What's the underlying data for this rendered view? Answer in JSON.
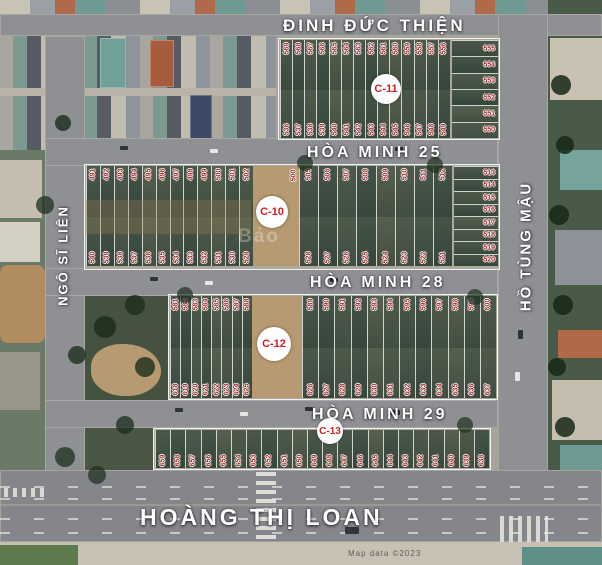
{
  "map": {
    "streets": {
      "dinh_duc_thien": "ĐINH ĐỨC THIỆN",
      "hoa_minh_25": "HÒA MINH 25",
      "hoa_minh_28": "HÒA MINH 28",
      "hoa_minh_29": "HÒA MINH 29",
      "hoang_thi_loan": "HOÀNG THỊ LOAN",
      "ngo_si_lien": "NGÔ SĨ LIÊN",
      "ho_tung_mau": "HỒ TÙNG MẬU"
    },
    "blocks": {
      "c11": {
        "label": "C-11",
        "top_row": [
          "569",
          "568",
          "567",
          "566",
          "565",
          "564",
          "563",
          "562",
          "561",
          "560",
          "559",
          "558",
          "557",
          "556"
        ],
        "bottom_row": [
          "536",
          "537",
          "538",
          "539",
          "540",
          "541",
          "542",
          "543",
          "544",
          "545",
          "546",
          "547",
          "548",
          "549"
        ],
        "stack": [
          "555",
          "554",
          "553",
          "552",
          "551",
          "550"
        ]
      },
      "c10": {
        "label": "C-10",
        "top_left": [
          "491",
          "492",
          "493",
          "494",
          "495",
          "496",
          "497",
          "498",
          "499",
          "500",
          "501",
          "502"
        ],
        "top_right": [
          "505",
          "506",
          "507",
          "508",
          "509",
          "510",
          "511",
          "512"
        ],
        "bottom_left": [
          "540",
          "539",
          "538",
          "537",
          "536",
          "535",
          "534",
          "533",
          "532",
          "531",
          "530",
          "529"
        ],
        "bottom_right": [
          "528",
          "527",
          "526",
          "525",
          "524",
          "523",
          "522",
          "521"
        ],
        "stack": [
          "513",
          "514",
          "515",
          "516",
          "517",
          "518",
          "519",
          "520"
        ],
        "gap_number": "500"
      },
      "c12": {
        "label": "C-12",
        "top_left": [
          "581",
          "582",
          "583",
          "584",
          "585",
          "586",
          "587",
          "588"
        ],
        "top_right": [
          "589",
          "590",
          "591",
          "592",
          "593",
          "594",
          "595",
          "596",
          "597",
          "598",
          "599",
          "600"
        ],
        "bottom_left": [
          "618",
          "619",
          "620",
          "621",
          "622",
          "623",
          "624",
          "625"
        ],
        "bottom_right": [
          "626",
          "627",
          "628",
          "629",
          "630",
          "631",
          "632",
          "633",
          "634",
          "635",
          "636",
          "637"
        ]
      },
      "c13": {
        "label": "C-13",
        "row": [
          "659",
          "658",
          "657",
          "656",
          "655",
          "654",
          "653",
          "652",
          "651",
          "650",
          "649",
          "648",
          "647",
          "646",
          "645",
          "644",
          "643",
          "642",
          "641",
          "640",
          "639",
          "638"
        ]
      }
    },
    "watermark": "Bảo",
    "attribution": "Map data ©2023",
    "colors": {
      "plot_number": "#a12f2f",
      "street_text": "#ffffff",
      "block_label": "#cc2222",
      "road": "#8f9094",
      "vegetation": "#43523f",
      "dirt": "#b79a71"
    }
  }
}
